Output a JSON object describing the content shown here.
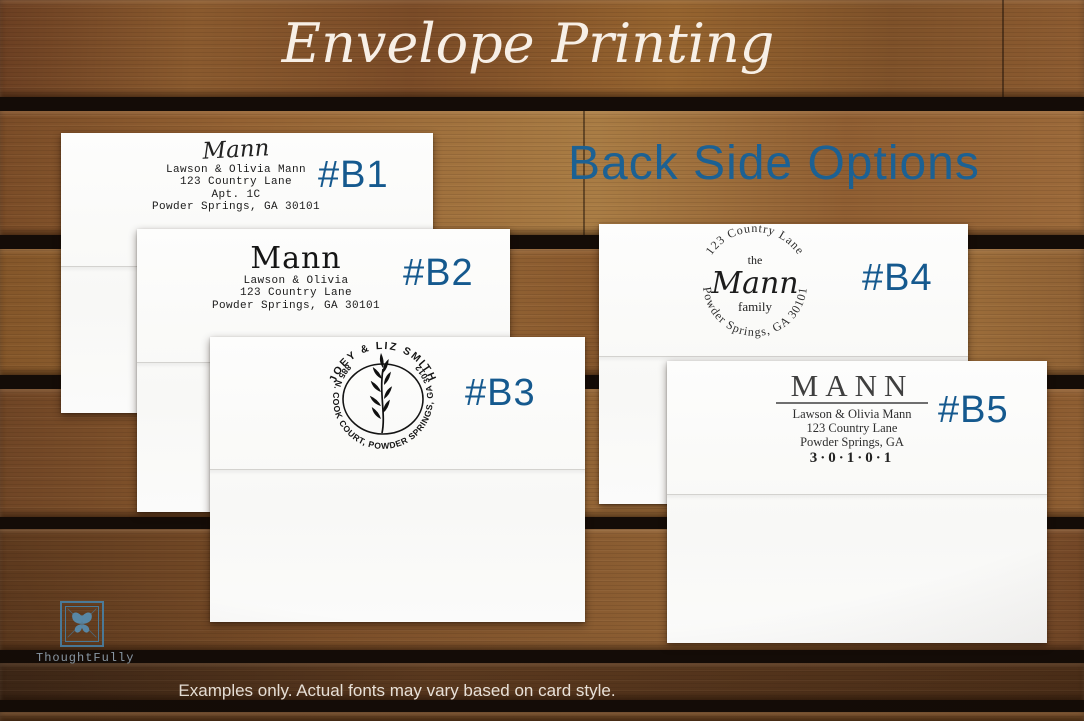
{
  "title": "Envelope Printing",
  "heading": "Back Side Options",
  "caption": "Examples only. Actual fonts may vary based on card style.",
  "brand": {
    "name": "ThoughtFully"
  },
  "colors": {
    "heading_blue": "#1c6193",
    "label_blue": "#15598e",
    "ink_black": "#1b1b1b",
    "wood_brown": "#8a5830",
    "envelope_white": "#fdfdfc"
  },
  "envelopes": [
    {
      "label": "#B1",
      "name": "Mann",
      "lines": [
        "Lawson & Olivia Mann",
        "123 Country Lane",
        "Apt. 1C",
        "Powder Springs, GA 30101"
      ]
    },
    {
      "label": "#B2",
      "name": "Mann",
      "lines": [
        "Lawson & Olivia",
        "123 Country Lane",
        "Powder Springs, GA 30101"
      ]
    },
    {
      "label": "#B3",
      "arc_top": "JOEY & LIZ SMITH",
      "arc_address": "1885 N. COOK COURT, POWDER SPRINGS, GA 30127"
    },
    {
      "label": "#B4",
      "arc_top": "123 Country Lane",
      "center_top": "the",
      "center_name": "Mann",
      "center_bottom": "family",
      "arc_bottom": "Powder Springs, GA 30101"
    },
    {
      "label": "#B5",
      "name": "MANN",
      "lines": [
        "Lawson & Olivia Mann",
        "123 Country Lane",
        "Powder Springs, GA"
      ],
      "zip": "3·0·1·0·1"
    }
  ]
}
